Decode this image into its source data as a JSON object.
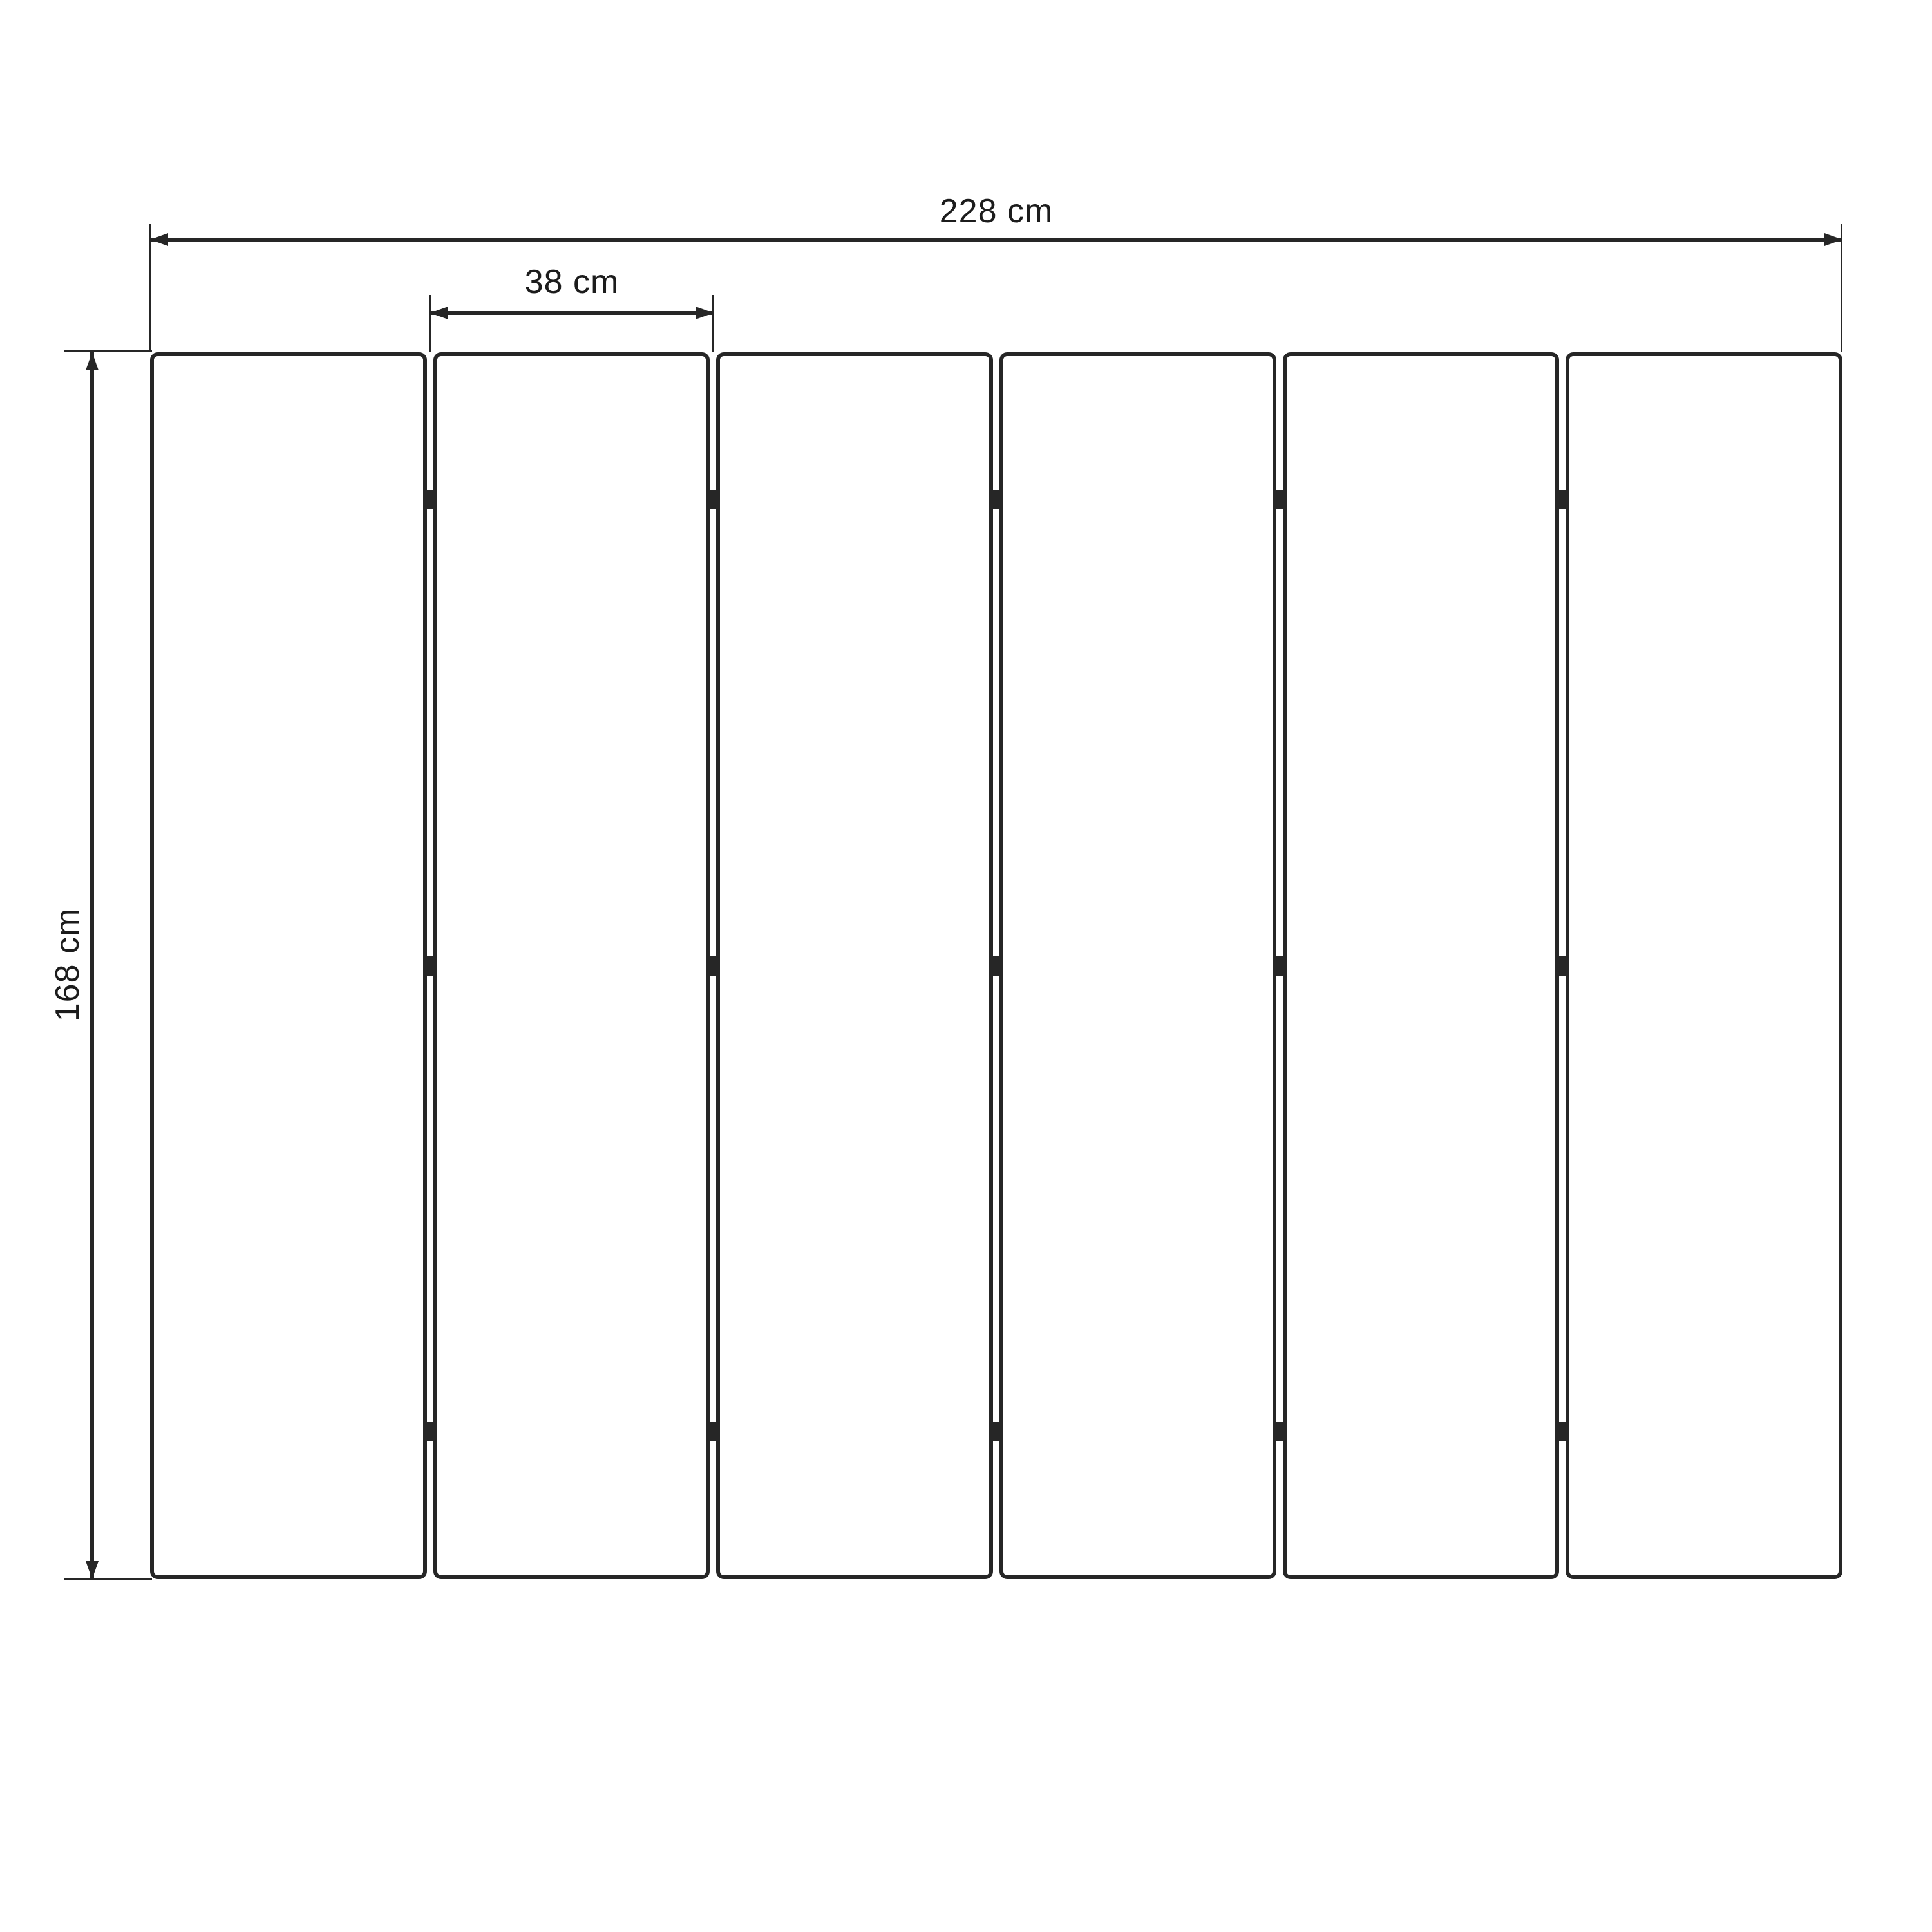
{
  "diagram": {
    "type": "dimension-drawing",
    "description": "Front view of a six-panel folding screen with hinge marks between panels",
    "panel_count": 6,
    "hinge_rows_per_gap": 3,
    "dimensions": {
      "total_width": {
        "value": 228,
        "unit": "cm",
        "label": "228 cm"
      },
      "panel_width": {
        "value": 38,
        "unit": "cm",
        "label": "38 cm"
      },
      "height": {
        "value": 168,
        "unit": "cm",
        "label": "168 cm"
      }
    },
    "colors": {
      "line": "#262626",
      "text": "#1c1c1c",
      "background": "#ffffff"
    }
  }
}
